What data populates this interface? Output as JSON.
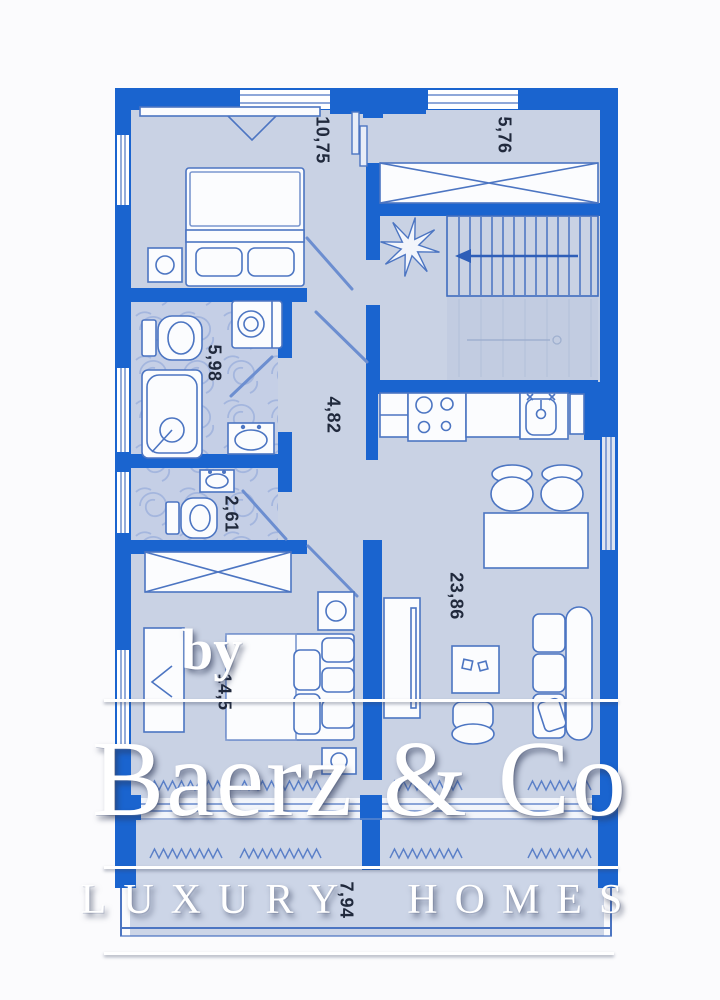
{
  "plan": {
    "room_labels": [
      {
        "room": "bedroom-top",
        "area": "10,75"
      },
      {
        "room": "storage-stairs",
        "area": "5,76"
      },
      {
        "room": "bathroom",
        "area": "5,98"
      },
      {
        "room": "hallway",
        "area": "4,82"
      },
      {
        "room": "wc",
        "area": "2,61"
      },
      {
        "room": "living-kitchen",
        "area": "23,86"
      },
      {
        "room": "bedroom-bottom",
        "area": "14,5"
      },
      {
        "room": "balcony",
        "area": "7,94"
      }
    ]
  },
  "watermark": {
    "prefix": "by",
    "brand": "Baerz & Co",
    "tagline": "LUXURY HOMES"
  },
  "colors": {
    "wall_blue": "#1a64cf",
    "floor": "#c9d2e4",
    "furniture_outline": "#4c75c2",
    "watermark_white": "#ffffff",
    "label_text": "#20293c"
  }
}
